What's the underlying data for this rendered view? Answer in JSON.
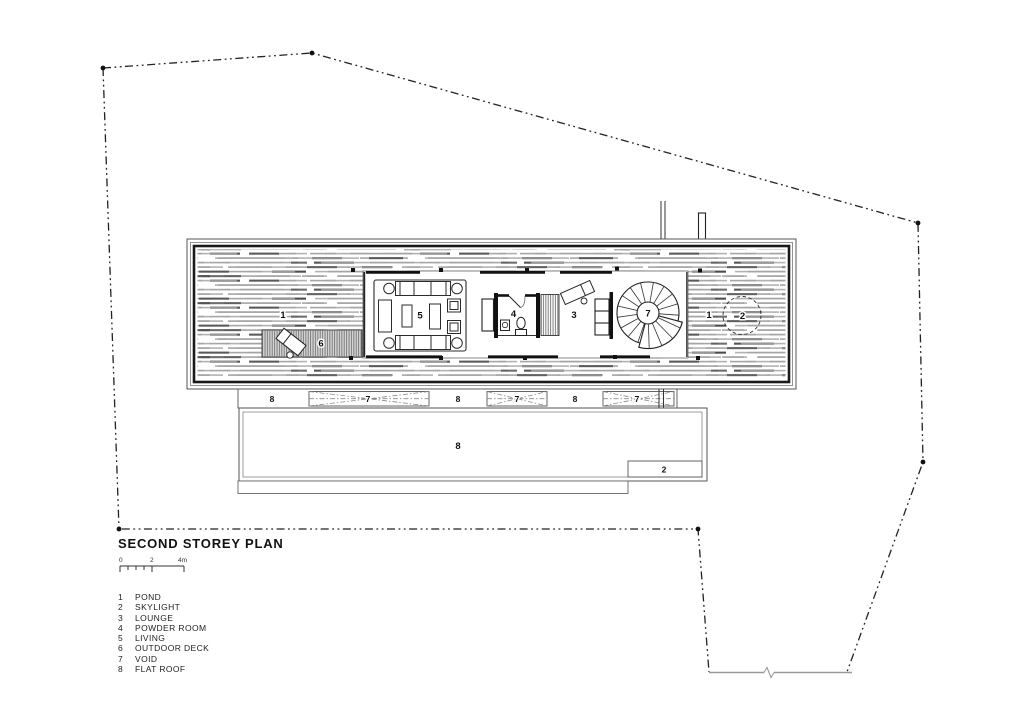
{
  "title": "SECOND STOREY PLAN",
  "scale_bar": {
    "t0": "0",
    "t2": "2",
    "t4": "4m"
  },
  "legend": {
    "items": [
      {
        "num": "1",
        "name": "POND"
      },
      {
        "num": "2",
        "name": "SKYLIGHT"
      },
      {
        "num": "3",
        "name": "LOUNGE"
      },
      {
        "num": "4",
        "name": "POWDER ROOM"
      },
      {
        "num": "5",
        "name": "LIVING"
      },
      {
        "num": "6",
        "name": "OUTDOOR DECK"
      },
      {
        "num": "7",
        "name": "VOID"
      },
      {
        "num": "8",
        "name": "FLAT ROOF"
      }
    ]
  },
  "plan": {
    "labels": {
      "pond_left": "1",
      "outdoor_deck": "6",
      "living": "5",
      "powder_room": "4",
      "lounge": "3",
      "void_stair": "7",
      "pond_right": "1",
      "skylight_circle": "2",
      "band": [
        "8",
        "7",
        "8",
        "7",
        "8",
        "7"
      ],
      "flat_roof": "8",
      "skylight_box": "2"
    }
  },
  "colors": {
    "ink": "#1c1c1c",
    "line_gray": "#8c8c8c",
    "pond_dash": "#a5a5a5",
    "pond_dark": "#4c4c4c"
  }
}
